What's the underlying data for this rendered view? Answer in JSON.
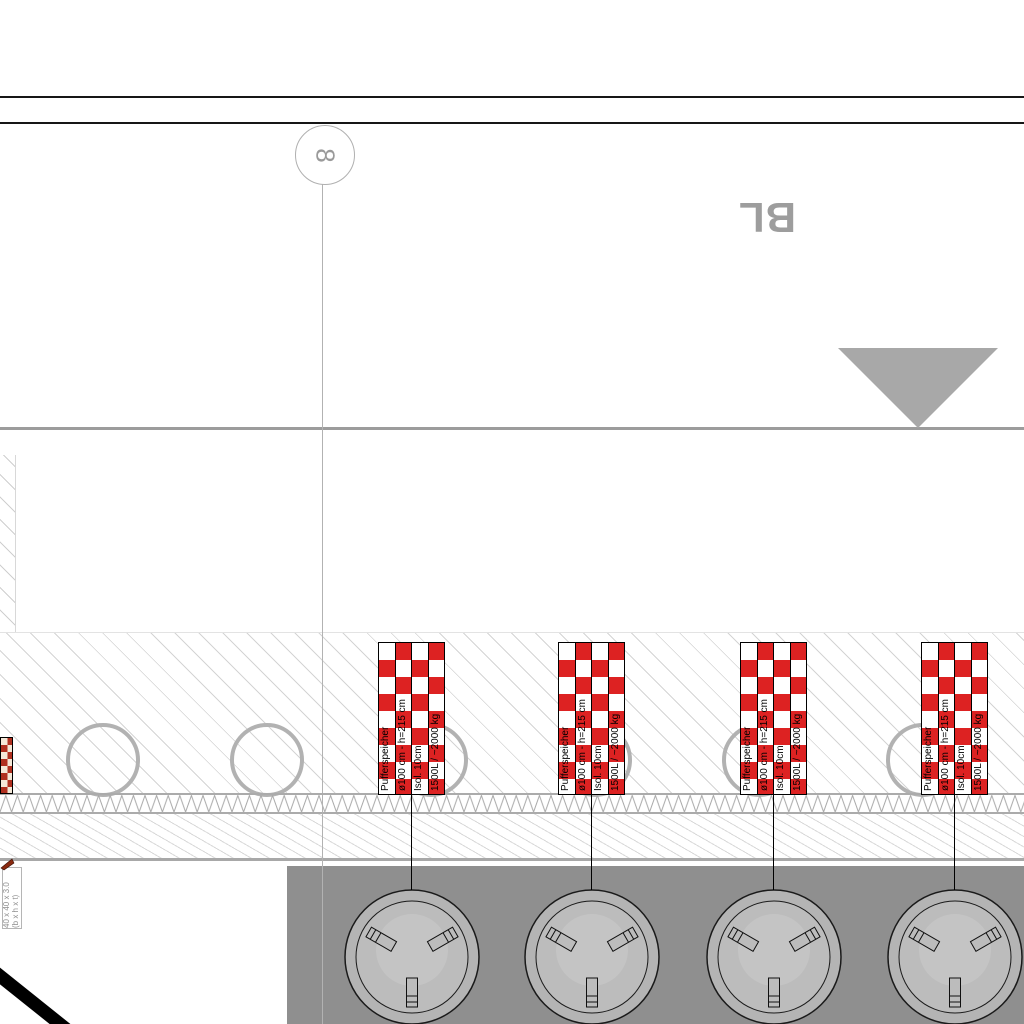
{
  "drawing": {
    "type": "construction-section-and-plan",
    "grid_marker": {
      "label": "8"
    },
    "section_label": "BL",
    "tank_label": {
      "line1": "Pufferspeicher",
      "line2": "ø100 cm - h=215 cm",
      "line3": "Isol. 10cm",
      "line4": "1500L / ~2000 kg"
    },
    "tank_count": 4,
    "angle_label": {
      "line1": "40 x 40 x 3.0",
      "line2": "(b x h x t)"
    },
    "colors": {
      "tank_checker_red": "#dd2222",
      "plan_background_gray": "#8f8f8f",
      "marker_gray": "#a8a8a8",
      "hatch_gray": "#d4d4d4",
      "line_black": "#111111"
    },
    "icons": {
      "level_marker": "downward-triangle-icon",
      "insulation_band": "zigzag-pattern"
    }
  }
}
